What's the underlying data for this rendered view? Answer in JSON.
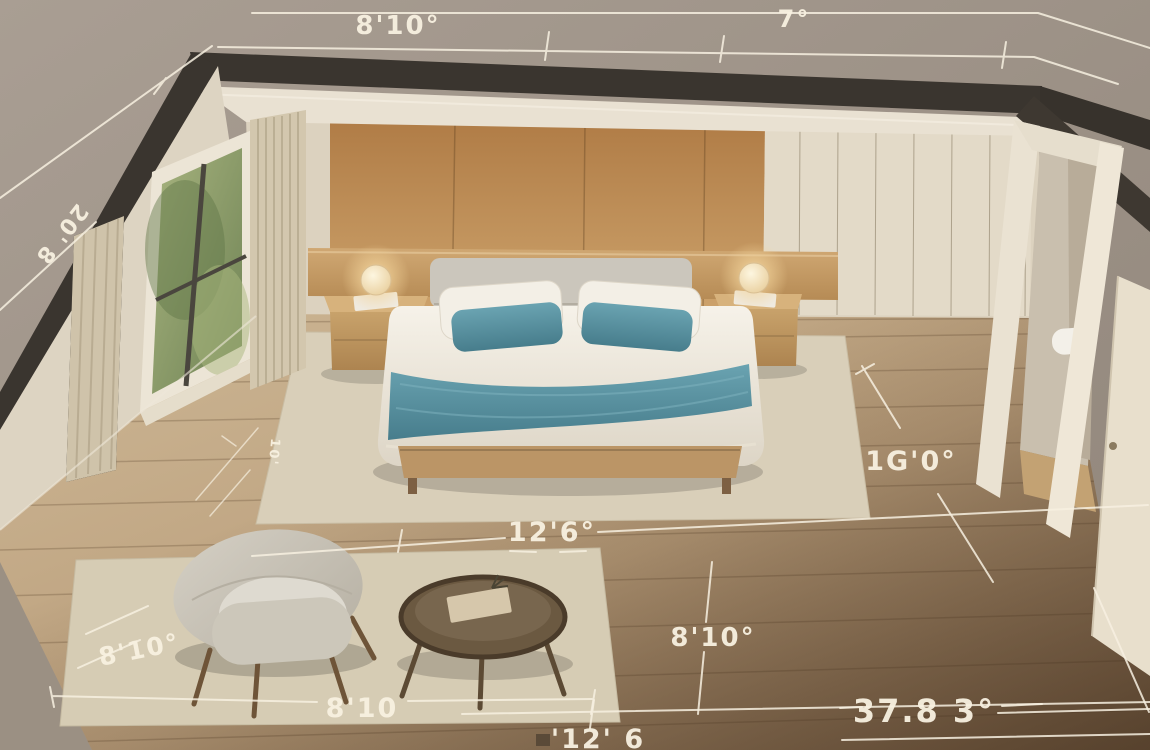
{
  "scene": {
    "description": "Isometric 3D render of a bedroom with dimension annotations",
    "objects": [
      "window",
      "curtains",
      "wood panel wall",
      "wardrobe",
      "bathroom doorway",
      "sink",
      "open door",
      "king bed",
      "pillows",
      "teal runner",
      "nightstands",
      "table lamps",
      "bed rug",
      "seating rug",
      "armchair",
      "round coffee table"
    ]
  },
  "measurements": {
    "top": "8'10°",
    "top_right": "7°",
    "left_wall": "20' 8",
    "rug_side": "10'",
    "bed_width": "12'6°",
    "room_depth": "1G'0°",
    "floor_right": "8'10°",
    "floor_left": "8'10°",
    "rug_bottom": "8'10",
    "total_width": "37.8 3°",
    "bottom_edge": "'12' 6"
  },
  "palette": {
    "accent_teal": "#5b96a6",
    "wood_wall": "#b98c58",
    "wardrobe_cream": "#e3dac8",
    "floor_light": "#c9b392",
    "floor_dark": "#7b6147",
    "wall_cut_dark": "#3a352f",
    "dimension_line": "#f6efdf",
    "exterior_taupe": "#a1968a"
  }
}
